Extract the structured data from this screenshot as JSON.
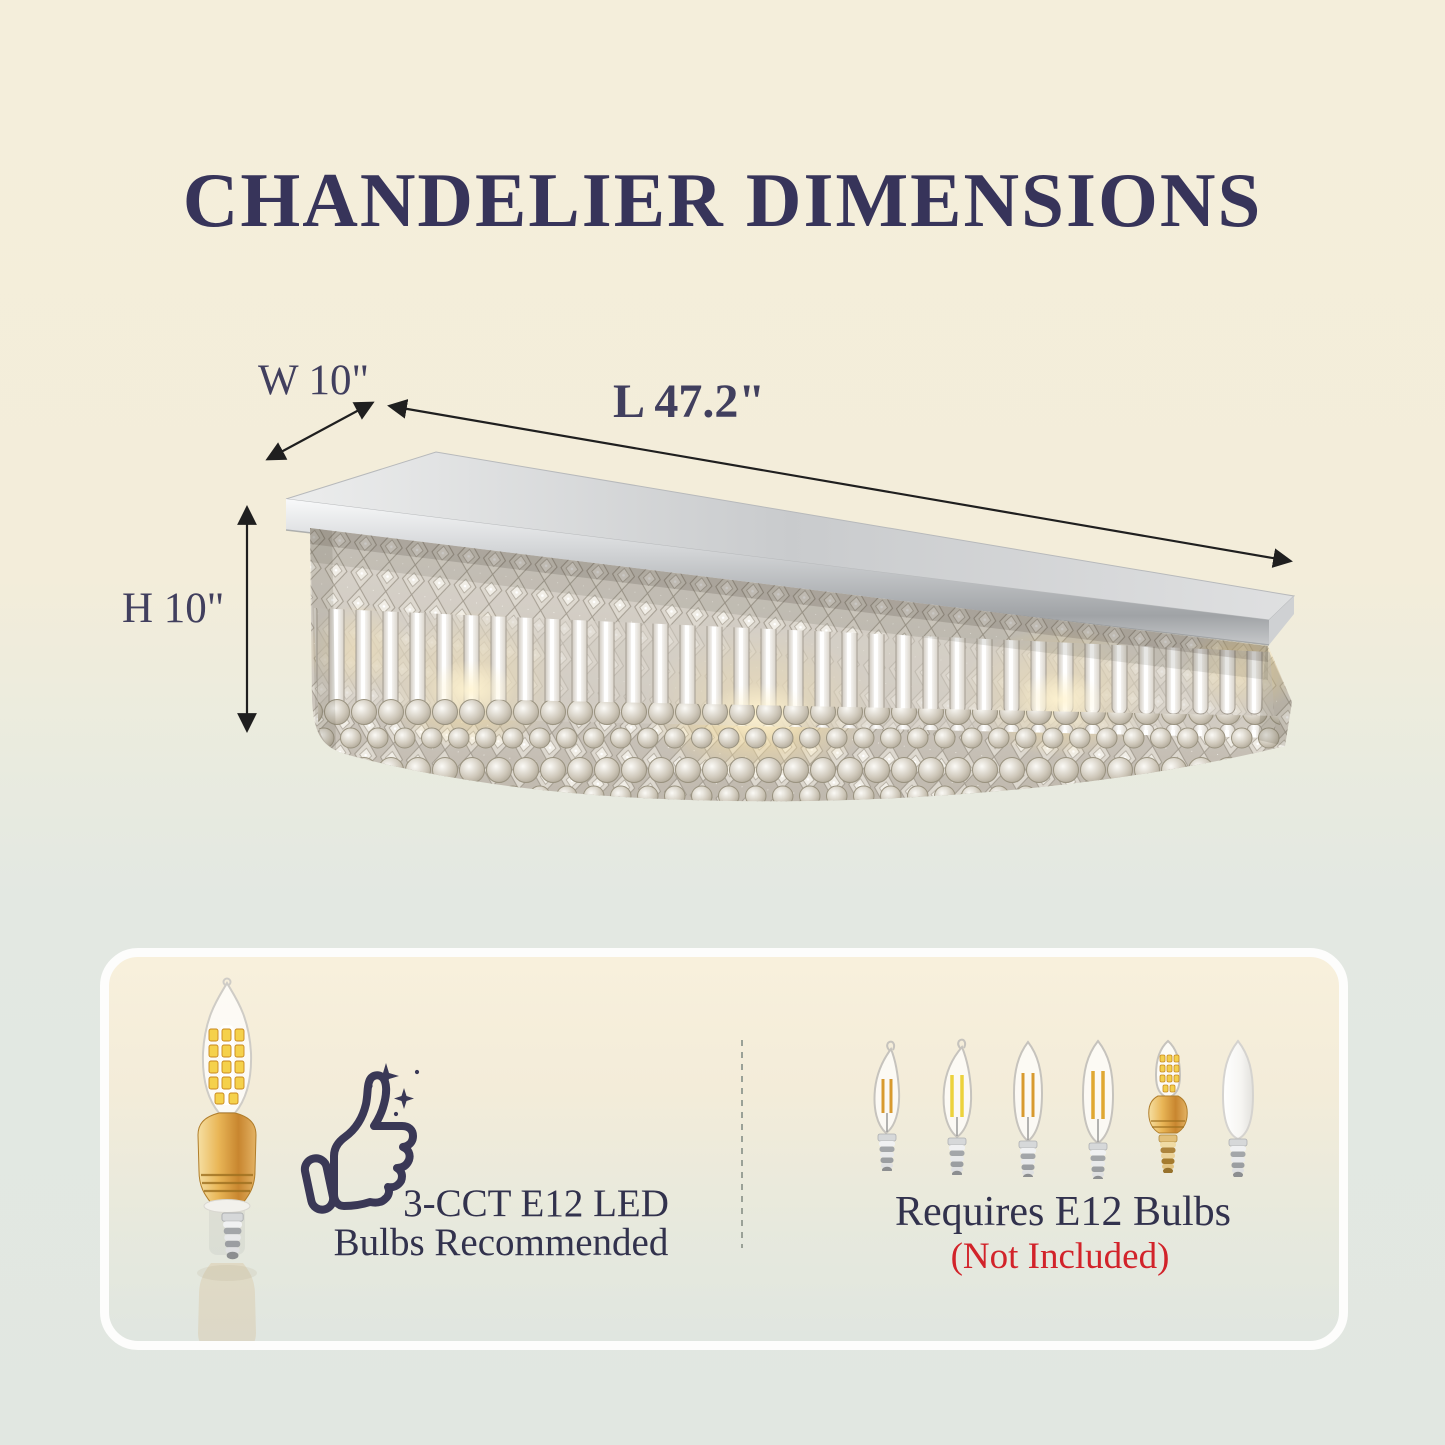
{
  "page": {
    "title": "CHANDELIER DIMENSIONS"
  },
  "dimensions": {
    "width_label": "W 10\"",
    "length_label": "L 47.2\"",
    "height_label": "H 10\""
  },
  "info_card": {
    "left": {
      "line1": "3-CCT E12 LED",
      "line2": "Bulbs Recommended"
    },
    "right": {
      "line1": "Requires E12 Bulbs",
      "line2": "(Not Included)"
    }
  },
  "icons": {
    "thumbs_up": "thumbs-up-outline-with-sparkles",
    "recommended_bulb": "gold-led-candle-bulb",
    "lineup": [
      "flame-tip-filament-bulb",
      "flame-tip-filament-bulb-large",
      "torpedo-filament-bulb",
      "torpedo-filament-bulb-large",
      "gold-led-candle-bulb",
      "frosted-candle-bulb"
    ],
    "dimension_arrows": [
      "width-arrow",
      "length-arrow",
      "height-arrow"
    ]
  },
  "colors": {
    "title": "#37345a",
    "body_text": "#32324d",
    "not_included_red": "#d2232a",
    "background_top": "#f4eedb",
    "background_bottom": "#e1e7e1",
    "card_top": "#f8f0dc",
    "card_bottom": "#e0e6e0",
    "arrow": "#1f1f1f"
  }
}
